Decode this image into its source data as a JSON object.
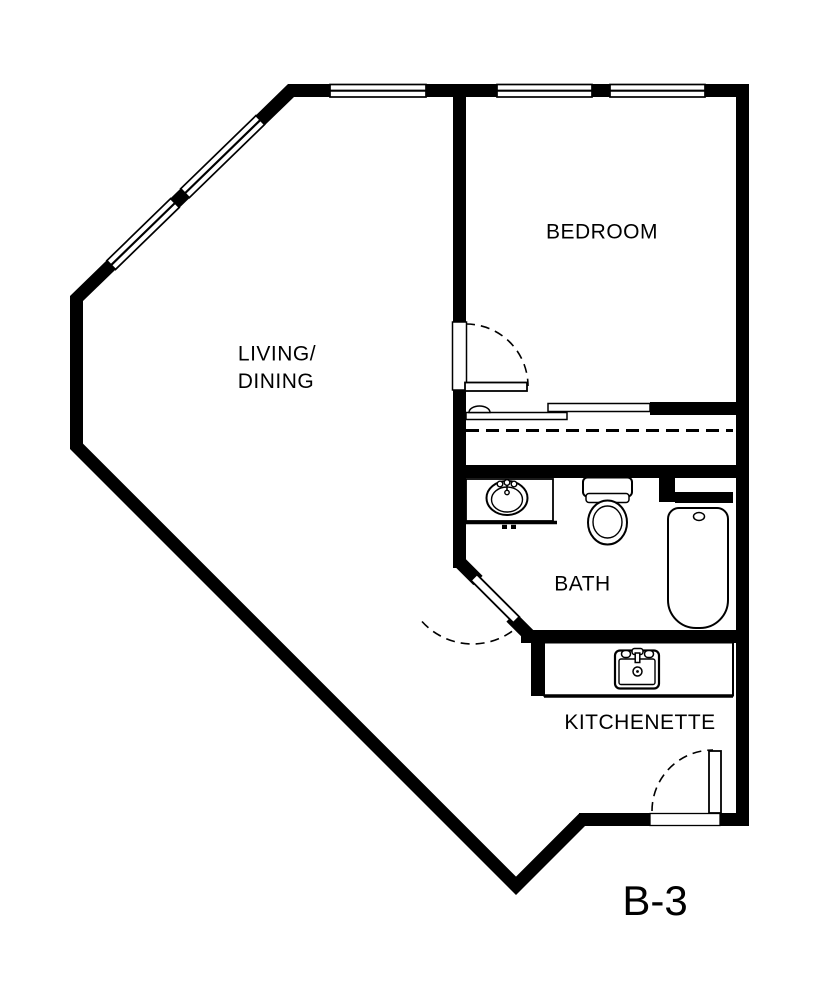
{
  "plan": {
    "unit_label": "B-3",
    "labels": {
      "bedroom": "BEDROOM",
      "living_line1": "LIVING/",
      "living_line2": "DINING",
      "bath": "BATH",
      "kitchenette": "KITCHENETTE"
    },
    "colors": {
      "wall": "#000000",
      "background": "#ffffff"
    }
  }
}
